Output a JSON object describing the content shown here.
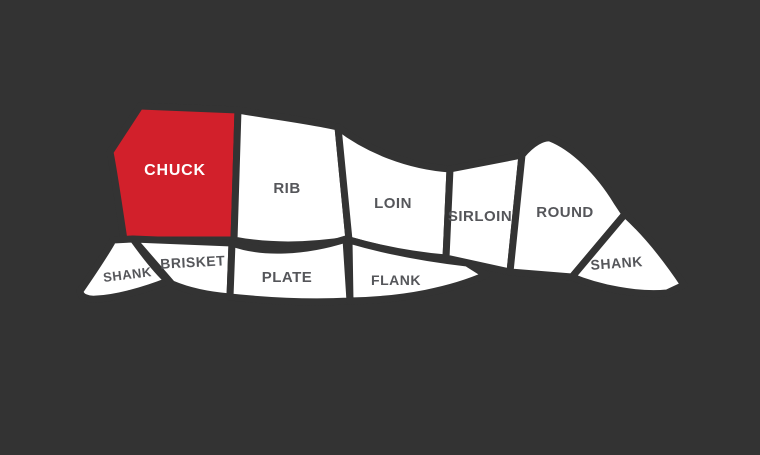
{
  "diagram": {
    "name": "beef-cuts-diagram"
  },
  "colors": {
    "background": "#333333",
    "cut_fill": "#ffffff",
    "highlight_fill": "#d2202b",
    "label_color": "#55565a",
    "highlight_label_color": "#ffffff"
  },
  "cuts": [
    {
      "id": "chuck",
      "label": "CHUCK",
      "highlighted": true
    },
    {
      "id": "rib",
      "label": "RIB",
      "highlighted": false
    },
    {
      "id": "loin",
      "label": "LOIN",
      "highlighted": false
    },
    {
      "id": "sirloin",
      "label": "SIRLOIN",
      "highlighted": false
    },
    {
      "id": "round",
      "label": "ROUND",
      "highlighted": false
    },
    {
      "id": "shank-rear",
      "label": "SHANK",
      "highlighted": false
    },
    {
      "id": "shank-front",
      "label": "SHANK",
      "highlighted": false
    },
    {
      "id": "brisket",
      "label": "BRISKET",
      "highlighted": false
    },
    {
      "id": "plate",
      "label": "PLATE",
      "highlighted": false
    },
    {
      "id": "flank",
      "label": "FLANK",
      "highlighted": false
    }
  ]
}
